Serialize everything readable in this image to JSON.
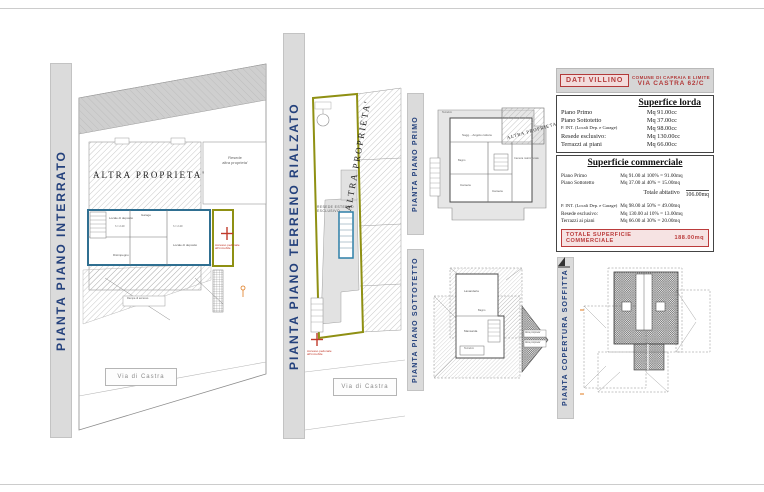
{
  "colors": {
    "label_blue": "#24417c",
    "plan_blue": "#2f6f91",
    "olive": "#8f9013",
    "red": "#c03a2b",
    "orange": "#e07b1f",
    "strip_gray": "#dbdbdb"
  },
  "labels": {
    "interrato": "PIANTA PIANO INTERRATO",
    "terreno": "PIANTA PIANO TERRENO RIALZATO",
    "primo": "PIANTA PIANO PRIMO",
    "sottotetto": "PIANTA PIANO SOTTOTETTO",
    "copertura": "PIANTA COPERTURA SOFFITTA"
  },
  "left_plan": {
    "altra_proprieta": "ALTRA PROPRIETA'",
    "resede_line1": "Resede",
    "resede_line2": "altra proprieta'",
    "via": "Via di Castra",
    "room1": "Locale di deposito",
    "room2": "Garage",
    "room3": "Locale di deposito",
    "room4": "Disimpegno",
    "h1": "h = 2.40",
    "h2": "h = 2.40",
    "rampa": "Rampa di accesso",
    "accesso_line1": "Accesso pedonale",
    "accesso_line2": "all'immobile"
  },
  "mid_plan": {
    "resede_line1": "RESEDE ESTERNO",
    "resede_line2": "ESCLUSIVO",
    "altra_proprieta": "ALTRA PROPRIETA'",
    "via": "Via di Castra",
    "accesso_line1": "Accesso pedonale",
    "accesso_line2": "all'immobile"
  },
  "primo_plan": {
    "altra_proprieta": "ALTRA PROPRIETA'",
    "terrazzo": "Terrazzo",
    "soggiorno": "Sogg. - Angolo cottura",
    "camera1": "Camera",
    "camera2": "Camera",
    "camera3": "Camera matrimoniale",
    "bagno": "Bagno"
  },
  "sottotetto_plan": {
    "lavanderia": "Lavanderia",
    "mansarda": "Mansarda",
    "bagno": "Bagno",
    "terrazzo": "Terrazzo",
    "falda1": "Altra proprieta'",
    "falda2": "Altra proprieta'"
  },
  "data_panel": {
    "dati_box": "DATI VILLINO",
    "comune_line1": "COMUNE DI CAPRAIA E LIMITE",
    "comune_line2": "VIA CASTRA 62/C",
    "lorda": {
      "title": "Superfice lorda",
      "rows": [
        {
          "label": "Piano Primo",
          "value": "Mq 91.00cc"
        },
        {
          "label": "Piano Sottotetto",
          "value": "Mq 37.00cc"
        },
        {
          "label": "P. INT.  (Locali Dep. e Garage)",
          "value": "Mq 98.00cc"
        },
        {
          "label": "Resede esclusivo:",
          "value": "Mq 130.00cc"
        },
        {
          "label": "Terrazzi ai piani",
          "value": "Mq 66.00cc"
        }
      ]
    },
    "commerciale": {
      "title": "Superficie commerciale",
      "rows_top": [
        {
          "label": "Piano Primo",
          "value": "Mq 91.00 al 100% = 91.00mq"
        },
        {
          "label": "Piano Sottotetto",
          "value": "Mq 37.00 al  40% = 15.00mq"
        }
      ],
      "totale_abitativo_label": "Totale abitativo",
      "totale_abitativo_value": "106.00mq",
      "rows_bottom": [
        {
          "label": "P. INT.  (Locali Dep. e Garage)",
          "value": "Mq 98.00 al  50% = 49.00mq"
        },
        {
          "label": "Resede esclusivo:",
          "value": "Mq 130.00 al 10% = 13.00mq"
        },
        {
          "label": "Terrazzi ai piani",
          "value": "Mq 66.00 al  30% = 20.00mq"
        }
      ],
      "totale_label": "TOTALE SUPERFICIE COMMERCIALE",
      "totale_value": "188.00mq"
    }
  }
}
